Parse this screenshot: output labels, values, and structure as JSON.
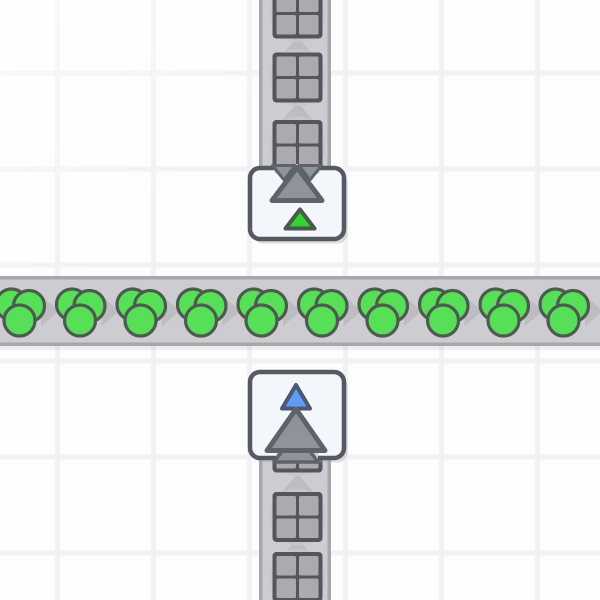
{
  "app": {
    "name": "factory-game-world",
    "view": "top-down-grid"
  },
  "canvas": {
    "width": 600,
    "height": 600,
    "background": "#fdfdfd"
  },
  "grid": {
    "line_color": "#f2f2f4",
    "line_thickness": 5,
    "cell_size": 96,
    "vertical_line_xs": [
      57.5,
      153.5,
      249.5,
      345.5,
      441.5,
      537.5
    ],
    "horizontal_line_ys": [
      73,
      169,
      265,
      361,
      457,
      553
    ]
  },
  "palette": {
    "belt_fill": "#cdcdd1",
    "belt_edge": "#a7a7ab",
    "belt_arrow": "#bdbdc1",
    "item_halo": "#c6c6cb",
    "belt_shadow": "rgba(120,120,130,0.12)",
    "square_item_fill": "#ababaf",
    "square_item_stroke": "#55555b",
    "circle_item_fill": "#57e057",
    "circle_item_stroke": "#4d5a50",
    "tile_fill": "#f3f6fb",
    "tile_stroke": "#555a62",
    "tile_shadow": "rgba(168,173,184,0.4)",
    "arrow_fill": "#8f939c",
    "arrow_stroke": "#5e626a",
    "marker_green": "#2fd42f",
    "marker_green_stroke": "#4b5850",
    "marker_blue": "#5f9cf3",
    "marker_blue_stroke": "#4e5770",
    "sheen": "rgba(255,255,255,0.55)"
  },
  "belts": {
    "horizontal": {
      "direction": "right",
      "band": {
        "x": 0,
        "y": 276,
        "width": 600,
        "height": 70
      },
      "edge_thickness": 3.5,
      "arrow_xs": [
        -10,
        50,
        110.5,
        171,
        231.5,
        292,
        352.5,
        413,
        473.5,
        534,
        594
      ],
      "item_type": "triple-circle-green-shape",
      "item_y": 312,
      "item_xs": [
        20,
        80.5,
        141,
        201.5,
        262,
        322.5,
        383,
        443.5,
        504,
        564
      ]
    },
    "vertical_top": {
      "direction": "up",
      "band": {
        "x": 259,
        "y": 0,
        "width": 72,
        "height": 174
      },
      "edge_length": 170,
      "arrow_ys": [
        45.5,
        111
      ],
      "item_type": "quad-square-gray-shape",
      "item_x": 297.5,
      "item_ys": [
        13.5,
        77.5,
        145
      ]
    },
    "vertical_bottom": {
      "direction": "up",
      "band": {
        "x": 259,
        "y": 450,
        "width": 72,
        "height": 150
      },
      "edge_start": 458,
      "arrow_ys": [
        482.5,
        547
      ],
      "item_type": "quad-square-gray-shape",
      "item_x": 297.5,
      "item_ys": [
        447.5,
        517,
        577
      ]
    }
  },
  "tunnel": {
    "exit_tile": {
      "name": "underground-belt-exit",
      "x": 250,
      "y": 168,
      "width": 94,
      "height": 71,
      "radius": 10,
      "mouth_side": "top",
      "arrow_direction": "up",
      "tier_marker": "green-triangle",
      "big_arrow": {
        "apex": [
          297,
          167.5
        ],
        "base_left": [
          272,
          200.5
        ],
        "base_right": [
          322,
          200.5
        ]
      },
      "marker_triangle": {
        "apex": [
          300,
          209.5
        ],
        "base_left": [
          285.5,
          228.5
        ],
        "base_right": [
          314.5,
          228.5
        ]
      },
      "mouth_cover": {
        "x": 274.5,
        "y": 164,
        "width": 45,
        "height": 9.5
      },
      "serration_left": [
        [
          272.5,
          165.5
        ],
        [
          295,
          165.5
        ],
        [
          284,
          180
        ]
      ],
      "serration_right": [
        [
          299,
          165.5
        ],
        [
          321.5,
          165.5
        ],
        [
          310,
          180
        ]
      ]
    },
    "entry_tile": {
      "name": "underground-belt-entry",
      "x": 250,
      "y": 372,
      "width": 94,
      "height": 86,
      "radius": 10,
      "mouth_side": "bottom",
      "arrow_direction": "up",
      "tier_marker": "blue-triangle",
      "big_arrow": {
        "apex": [
          296,
          409
        ],
        "base_left": [
          267,
          450.5
        ],
        "base_right": [
          325,
          450.5
        ]
      },
      "marker_triangle": {
        "apex": [
          296,
          385
        ],
        "base_left": [
          282,
          408.5
        ],
        "base_right": [
          310,
          408.5
        ]
      },
      "mouth_cover": {
        "x": 276,
        "y": 452.5,
        "width": 42,
        "height": 9.5
      },
      "skirt": [
        [
          286,
          446
        ],
        [
          306,
          446
        ],
        [
          318,
          462
        ],
        [
          274,
          462
        ]
      ]
    }
  },
  "item_geometry": {
    "circle_cluster": {
      "radius": 15.5,
      "stroke_width": 3.2,
      "offsets": [
        [
          -8.5,
          -7.5
        ],
        [
          9,
          -6
        ],
        [
          -0.5,
          8.5
        ]
      ]
    },
    "square_item": {
      "outer": 50,
      "border": 4,
      "gap": 3,
      "corner_radius": 4
    },
    "halo_radius": 28.5,
    "arrow": {
      "across": 30,
      "along": 18
    }
  }
}
